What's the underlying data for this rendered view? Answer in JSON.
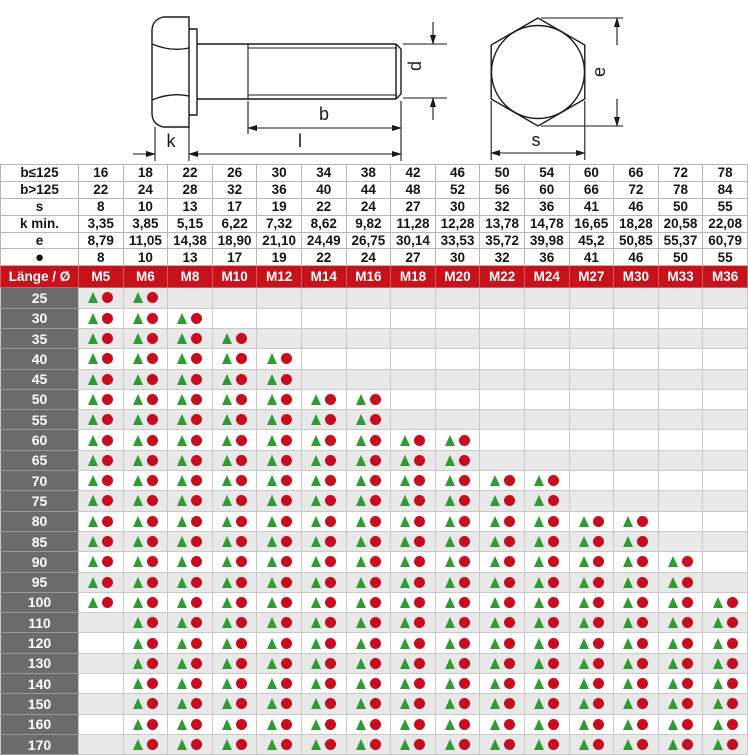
{
  "colors": {
    "header_red": "#c5121b",
    "length_column_gray": "#6b6b6b",
    "stripe_gray": "#e8e8e8",
    "triangle_green": "#2f9b32",
    "dot_red": "#c60d1f"
  },
  "drawing": {
    "labels": {
      "k": "k",
      "b": "b",
      "l": "l",
      "d": "d",
      "e": "e",
      "s": "s"
    }
  },
  "dimension_table": {
    "rows": [
      {
        "label": "b≤125",
        "values": [
          "16",
          "18",
          "22",
          "26",
          "30",
          "34",
          "38",
          "42",
          "46",
          "50",
          "54",
          "60",
          "66",
          "72",
          "78"
        ]
      },
      {
        "label": "b>125",
        "values": [
          "22",
          "24",
          "28",
          "32",
          "36",
          "40",
          "44",
          "48",
          "52",
          "56",
          "60",
          "66",
          "72",
          "78",
          "84"
        ]
      },
      {
        "label": "s",
        "values": [
          "8",
          "10",
          "13",
          "17",
          "19",
          "22",
          "24",
          "27",
          "30",
          "32",
          "36",
          "41",
          "46",
          "50",
          "55"
        ]
      },
      {
        "label": "k min.",
        "values": [
          "3,35",
          "3,85",
          "5,15",
          "6,22",
          "7,32",
          "8,62",
          "9,82",
          "11,28",
          "12,28",
          "13,78",
          "14,78",
          "16,65",
          "18,28",
          "20,58",
          "22,08"
        ]
      },
      {
        "label": "e",
        "values": [
          "8,79",
          "11,05",
          "14,38",
          "18,90",
          "21,10",
          "24,49",
          "26,75",
          "30,14",
          "33,53",
          "35,72",
          "39,98",
          "45,2",
          "50,85",
          "55,37",
          "60,79"
        ]
      },
      {
        "label": "●",
        "values": [
          "8",
          "10",
          "13",
          "17",
          "19",
          "22",
          "24",
          "27",
          "30",
          "32",
          "36",
          "41",
          "46",
          "50",
          "55"
        ]
      }
    ]
  },
  "availability_table": {
    "corner_label": "Länge / Ø",
    "sizes": [
      "M5",
      "M6",
      "M8",
      "M10",
      "M12",
      "M14",
      "M16",
      "M18",
      "M20",
      "M22",
      "M24",
      "M27",
      "M30",
      "M33",
      "M36"
    ],
    "marker_meaning": {
      "triangle": "triangle-marker",
      "dot": "dot-marker"
    },
    "rows": [
      {
        "length": "25",
        "cells": [
          1,
          1,
          0,
          0,
          0,
          0,
          0,
          0,
          0,
          0,
          0,
          0,
          0,
          0,
          0
        ]
      },
      {
        "length": "30",
        "cells": [
          1,
          1,
          1,
          0,
          0,
          0,
          0,
          0,
          0,
          0,
          0,
          0,
          0,
          0,
          0
        ]
      },
      {
        "length": "35",
        "cells": [
          1,
          1,
          1,
          1,
          0,
          0,
          0,
          0,
          0,
          0,
          0,
          0,
          0,
          0,
          0
        ]
      },
      {
        "length": "40",
        "cells": [
          1,
          1,
          1,
          1,
          1,
          0,
          0,
          0,
          0,
          0,
          0,
          0,
          0,
          0,
          0
        ]
      },
      {
        "length": "45",
        "cells": [
          1,
          1,
          1,
          1,
          1,
          0,
          0,
          0,
          0,
          0,
          0,
          0,
          0,
          0,
          0
        ]
      },
      {
        "length": "50",
        "cells": [
          1,
          1,
          1,
          1,
          1,
          1,
          1,
          0,
          0,
          0,
          0,
          0,
          0,
          0,
          0
        ]
      },
      {
        "length": "55",
        "cells": [
          1,
          1,
          1,
          1,
          1,
          1,
          1,
          0,
          0,
          0,
          0,
          0,
          0,
          0,
          0
        ]
      },
      {
        "length": "60",
        "cells": [
          1,
          1,
          1,
          1,
          1,
          1,
          1,
          1,
          1,
          0,
          0,
          0,
          0,
          0,
          0
        ]
      },
      {
        "length": "65",
        "cells": [
          1,
          1,
          1,
          1,
          1,
          1,
          1,
          1,
          1,
          0,
          0,
          0,
          0,
          0,
          0
        ]
      },
      {
        "length": "70",
        "cells": [
          1,
          1,
          1,
          1,
          1,
          1,
          1,
          1,
          1,
          1,
          1,
          0,
          0,
          0,
          0
        ]
      },
      {
        "length": "75",
        "cells": [
          1,
          1,
          1,
          1,
          1,
          1,
          1,
          1,
          1,
          1,
          1,
          0,
          0,
          0,
          0
        ]
      },
      {
        "length": "80",
        "cells": [
          1,
          1,
          1,
          1,
          1,
          1,
          1,
          1,
          1,
          1,
          1,
          1,
          1,
          0,
          0
        ]
      },
      {
        "length": "85",
        "cells": [
          1,
          1,
          1,
          1,
          1,
          1,
          1,
          1,
          1,
          1,
          1,
          1,
          1,
          0,
          0
        ]
      },
      {
        "length": "90",
        "cells": [
          1,
          1,
          1,
          1,
          1,
          1,
          1,
          1,
          1,
          1,
          1,
          1,
          1,
          1,
          0
        ]
      },
      {
        "length": "95",
        "cells": [
          1,
          1,
          1,
          1,
          1,
          1,
          1,
          1,
          1,
          1,
          1,
          1,
          1,
          1,
          0
        ]
      },
      {
        "length": "100",
        "cells": [
          1,
          1,
          1,
          1,
          1,
          1,
          1,
          1,
          1,
          1,
          1,
          1,
          1,
          1,
          1
        ]
      },
      {
        "length": "110",
        "cells": [
          0,
          1,
          1,
          1,
          1,
          1,
          1,
          1,
          1,
          1,
          1,
          1,
          1,
          1,
          1
        ]
      },
      {
        "length": "120",
        "cells": [
          0,
          1,
          1,
          1,
          1,
          1,
          1,
          1,
          1,
          1,
          1,
          1,
          1,
          1,
          1
        ]
      },
      {
        "length": "130",
        "cells": [
          0,
          1,
          1,
          1,
          1,
          1,
          1,
          1,
          1,
          1,
          1,
          1,
          1,
          1,
          1
        ]
      },
      {
        "length": "140",
        "cells": [
          0,
          1,
          1,
          1,
          1,
          1,
          1,
          1,
          1,
          1,
          1,
          1,
          1,
          1,
          1
        ]
      },
      {
        "length": "150",
        "cells": [
          0,
          1,
          1,
          1,
          1,
          1,
          1,
          1,
          1,
          1,
          1,
          1,
          1,
          1,
          1
        ]
      },
      {
        "length": "160",
        "cells": [
          0,
          1,
          1,
          1,
          1,
          1,
          1,
          1,
          1,
          1,
          1,
          1,
          1,
          1,
          1
        ]
      },
      {
        "length": "170",
        "cells": [
          0,
          1,
          1,
          1,
          1,
          1,
          1,
          1,
          1,
          1,
          1,
          1,
          1,
          1,
          1
        ]
      }
    ]
  }
}
